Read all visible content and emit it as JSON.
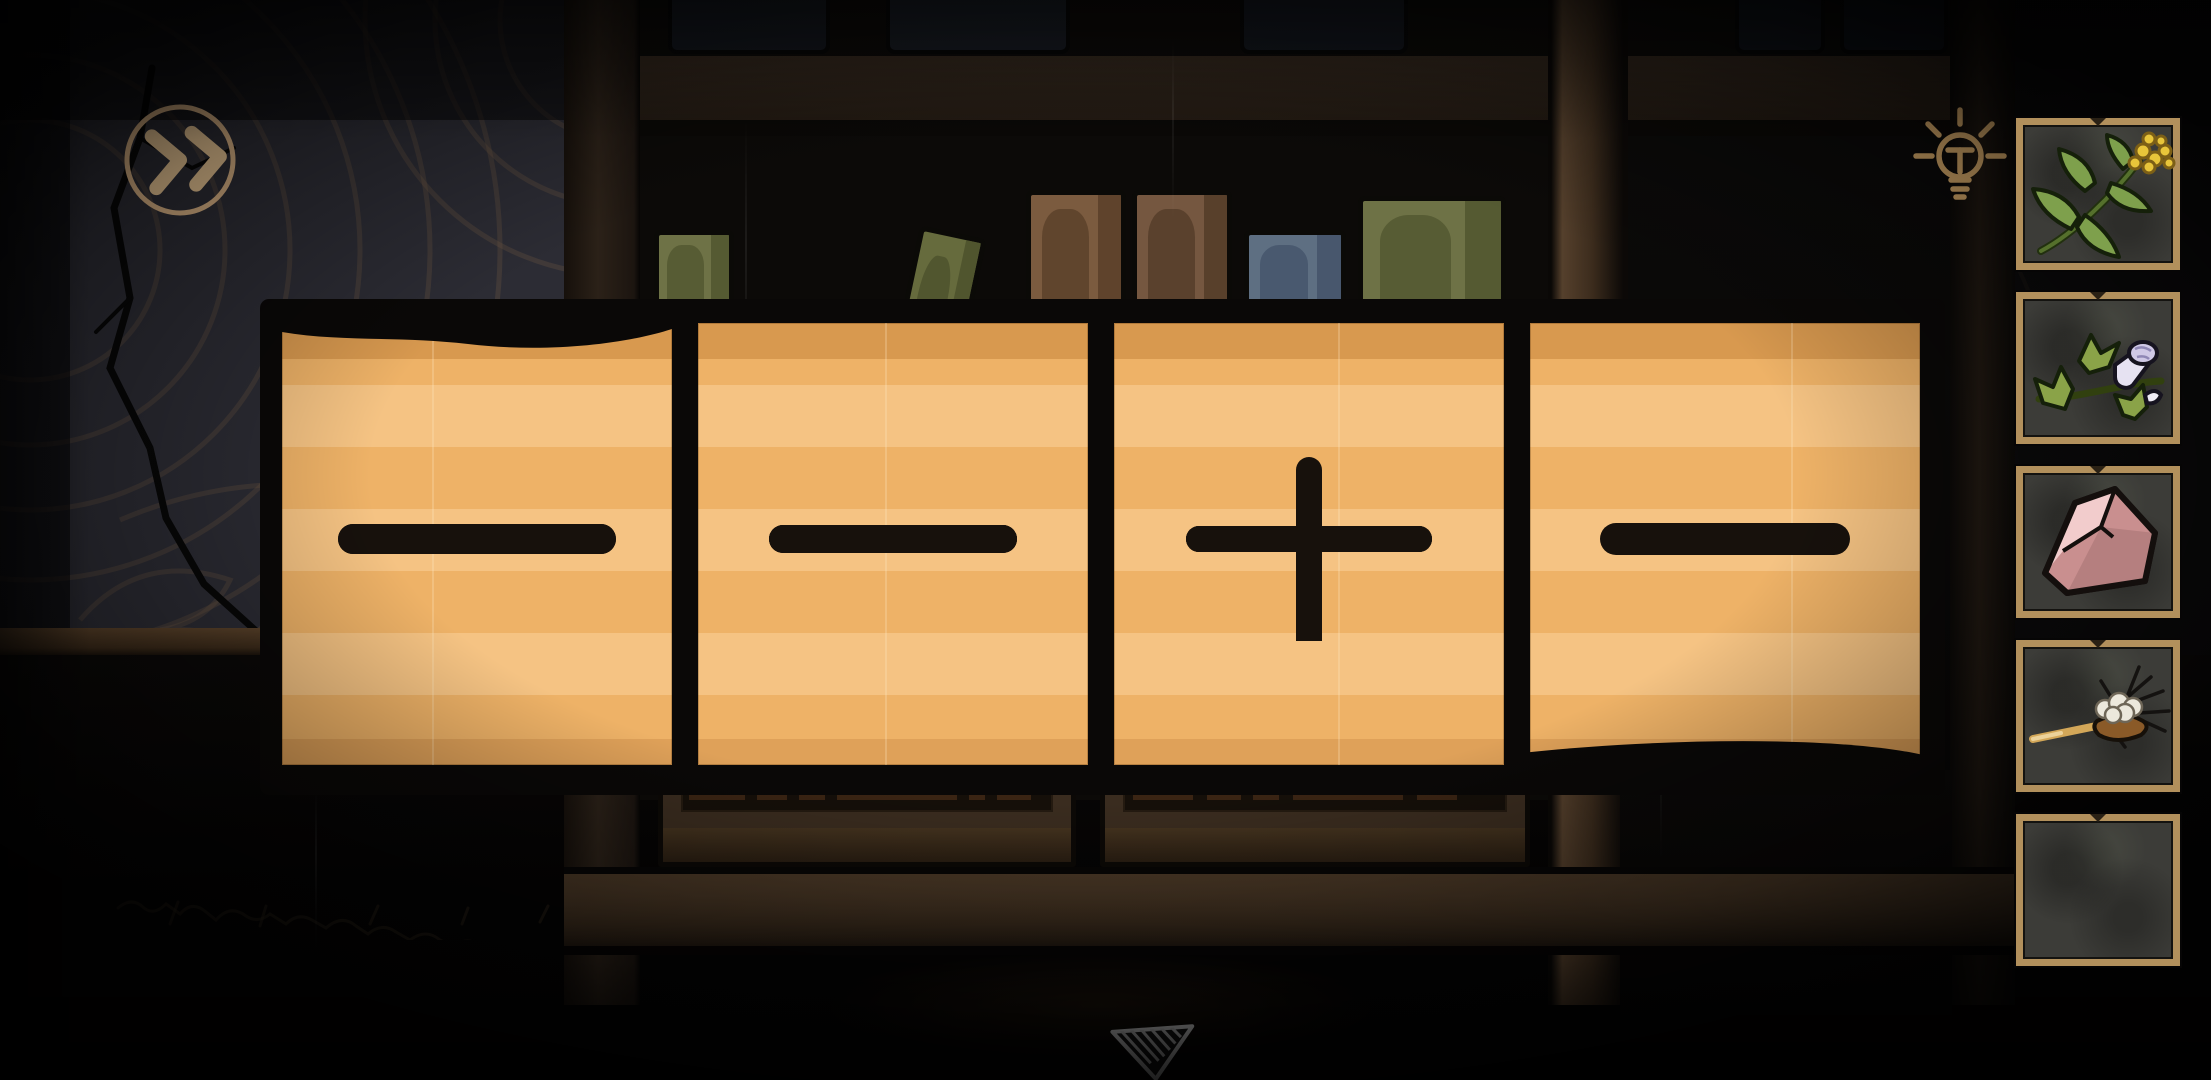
{
  "screen": {
    "name": "bookshelf-puzzle-room"
  },
  "hud": {
    "skip_button": {
      "icon": "double-chevron-right-icon",
      "label": "fast-forward",
      "color": "#e7c493"
    },
    "hint_button": {
      "icon": "lightbulb-hint-icon",
      "label": "hint",
      "color": "#dcae6d"
    },
    "down_arrow": {
      "icon": "down-triangle-icon",
      "label": "look-down",
      "color": "#ededed"
    }
  },
  "puzzle_cards": {
    "description": "four tan paper cards bearing black bar symbols",
    "paper_color": "#efb76f",
    "ink_color": "#17110c",
    "cards": [
      {
        "name": "card-1",
        "symbol": "two-horizontal-bars",
        "bar_count": 2,
        "has_stem": false
      },
      {
        "name": "card-2",
        "symbol": "three-horizontal-bars",
        "bar_count": 3,
        "has_stem": false
      },
      {
        "name": "card-3",
        "symbol": "vertical-stem-over-three-bars",
        "bar_count": 3,
        "has_stem": true
      },
      {
        "name": "card-4",
        "symbol": "one-horizontal-bar",
        "bar_count": 1,
        "has_stem": false
      }
    ]
  },
  "inventory": {
    "slot_border_color": "#b2905c",
    "slots": [
      {
        "name": "slot-1",
        "item": "yellow-flower-sprig",
        "empty": false
      },
      {
        "name": "slot-2",
        "item": "white-trumpet-flower-sprig",
        "empty": false
      },
      {
        "name": "slot-3",
        "item": "pink-rock",
        "empty": false
      },
      {
        "name": "slot-4",
        "item": "dried-root-on-stick",
        "empty": false
      },
      {
        "name": "slot-5",
        "item": "",
        "empty": true
      }
    ]
  },
  "scene": {
    "wall_accent_color": "#6f5a43",
    "bookshelf_books": [
      {
        "name": "olive-book-upright",
        "face": "#6e7246",
        "side": "#51562f"
      },
      {
        "name": "olive-book-tilted-a",
        "face": "#5f6438",
        "side": "#474b29"
      },
      {
        "name": "olive-book-tilted-b",
        "face": "#666b3d",
        "side": "#4c512c"
      },
      {
        "name": "brown-book-1",
        "face": "#7b5b3f",
        "side": "#5a4029"
      },
      {
        "name": "brown-book-2",
        "face": "#755740",
        "side": "#543c28"
      },
      {
        "name": "blue-book",
        "face": "#5e6f82",
        "side": "#44546a"
      },
      {
        "name": "olive-book-wide",
        "face": "#6e7246",
        "side": "#51562f"
      }
    ]
  }
}
